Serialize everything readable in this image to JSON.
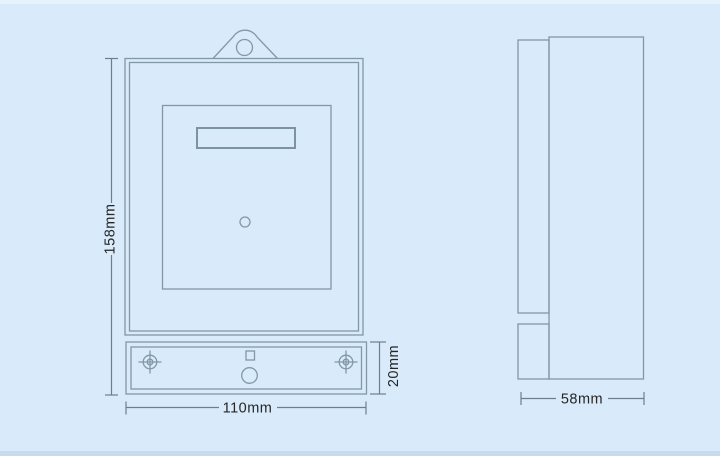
{
  "drawing": {
    "type": "technical-dimension-drawing",
    "subject": "single-phase energy meter enclosure, front and side orthographic views",
    "views": {
      "front": {
        "overall_height_label": "158mm",
        "overall_width_label": "110mm",
        "terminal_cover_height_label": "20mm"
      },
      "side": {
        "depth_label": "58mm"
      }
    },
    "colors": {
      "background": "#d9eafa",
      "background_top_highlight": "#e6f2fc",
      "background_bottom_strip": "#c6dcee",
      "outline": "#8398a7",
      "dimension_text": "#262626"
    }
  }
}
